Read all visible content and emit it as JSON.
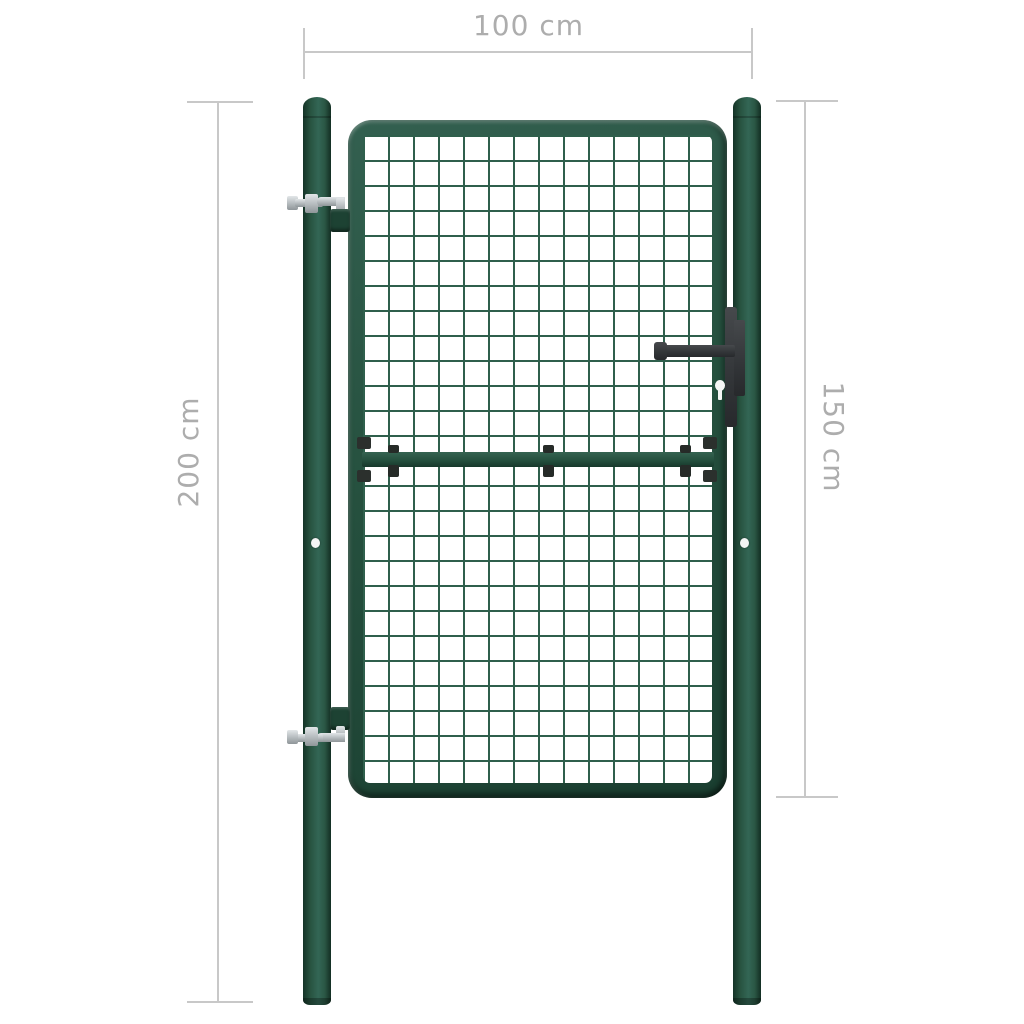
{
  "diagram": {
    "dimensions": {
      "width_label": "100 cm",
      "post_height_label": "200 cm",
      "gate_height_label": "150 cm"
    },
    "colors": {
      "gate_green": "#26523F",
      "gate_green_highlight": "#356553",
      "gate_green_shadow": "#143127",
      "mesh_wire_green": "#2F5F4C",
      "hardware_dark_gray": "#35383A",
      "hinge_metal_silver": "#C8CDCF",
      "dimension_line_gray": "#C8C8C8",
      "dimension_text_gray": "#ADADAD",
      "background_white": "#FFFFFF"
    }
  }
}
